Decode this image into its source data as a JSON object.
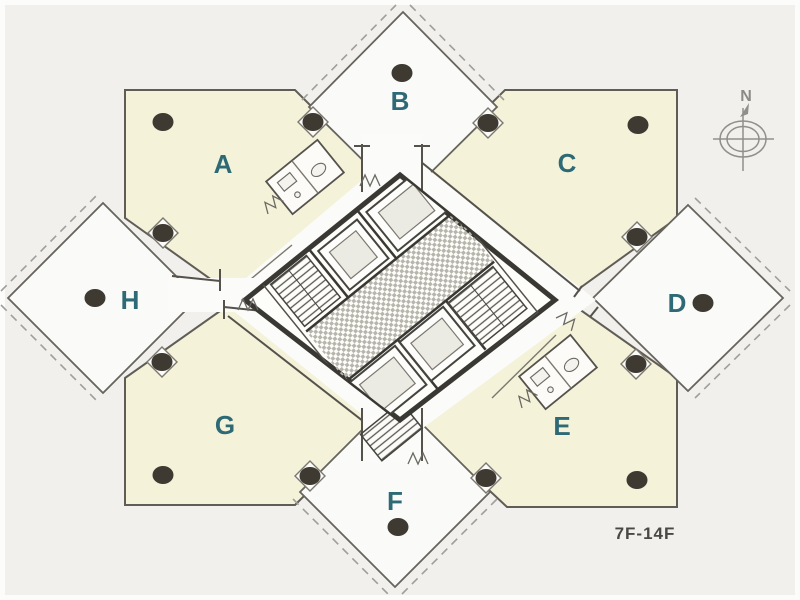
{
  "floor_plan": {
    "title": "Tower typical floor plan",
    "floor_range": "7F-14F",
    "compass": {
      "north_label": "N"
    },
    "units": [
      {
        "id": "A",
        "label": "A"
      },
      {
        "id": "B",
        "label": "B"
      },
      {
        "id": "C",
        "label": "C"
      },
      {
        "id": "D",
        "label": "D"
      },
      {
        "id": "E",
        "label": "E"
      },
      {
        "id": "F",
        "label": "F"
      },
      {
        "id": "G",
        "label": "G"
      },
      {
        "id": "H",
        "label": "H"
      }
    ],
    "column_dot_count": 16,
    "colors": {
      "background": "#f1f0ed",
      "unit_fill_cream": "#f5f2da",
      "unit_fill_white": "#fafaf8",
      "wall": "#55524c",
      "core_wall": "#3a3832",
      "label_teal": "#2e6a76",
      "column_dot": "#3e3a32",
      "compass_gray": "#8f8f8b",
      "floor_label_color": "#4a4843"
    }
  }
}
